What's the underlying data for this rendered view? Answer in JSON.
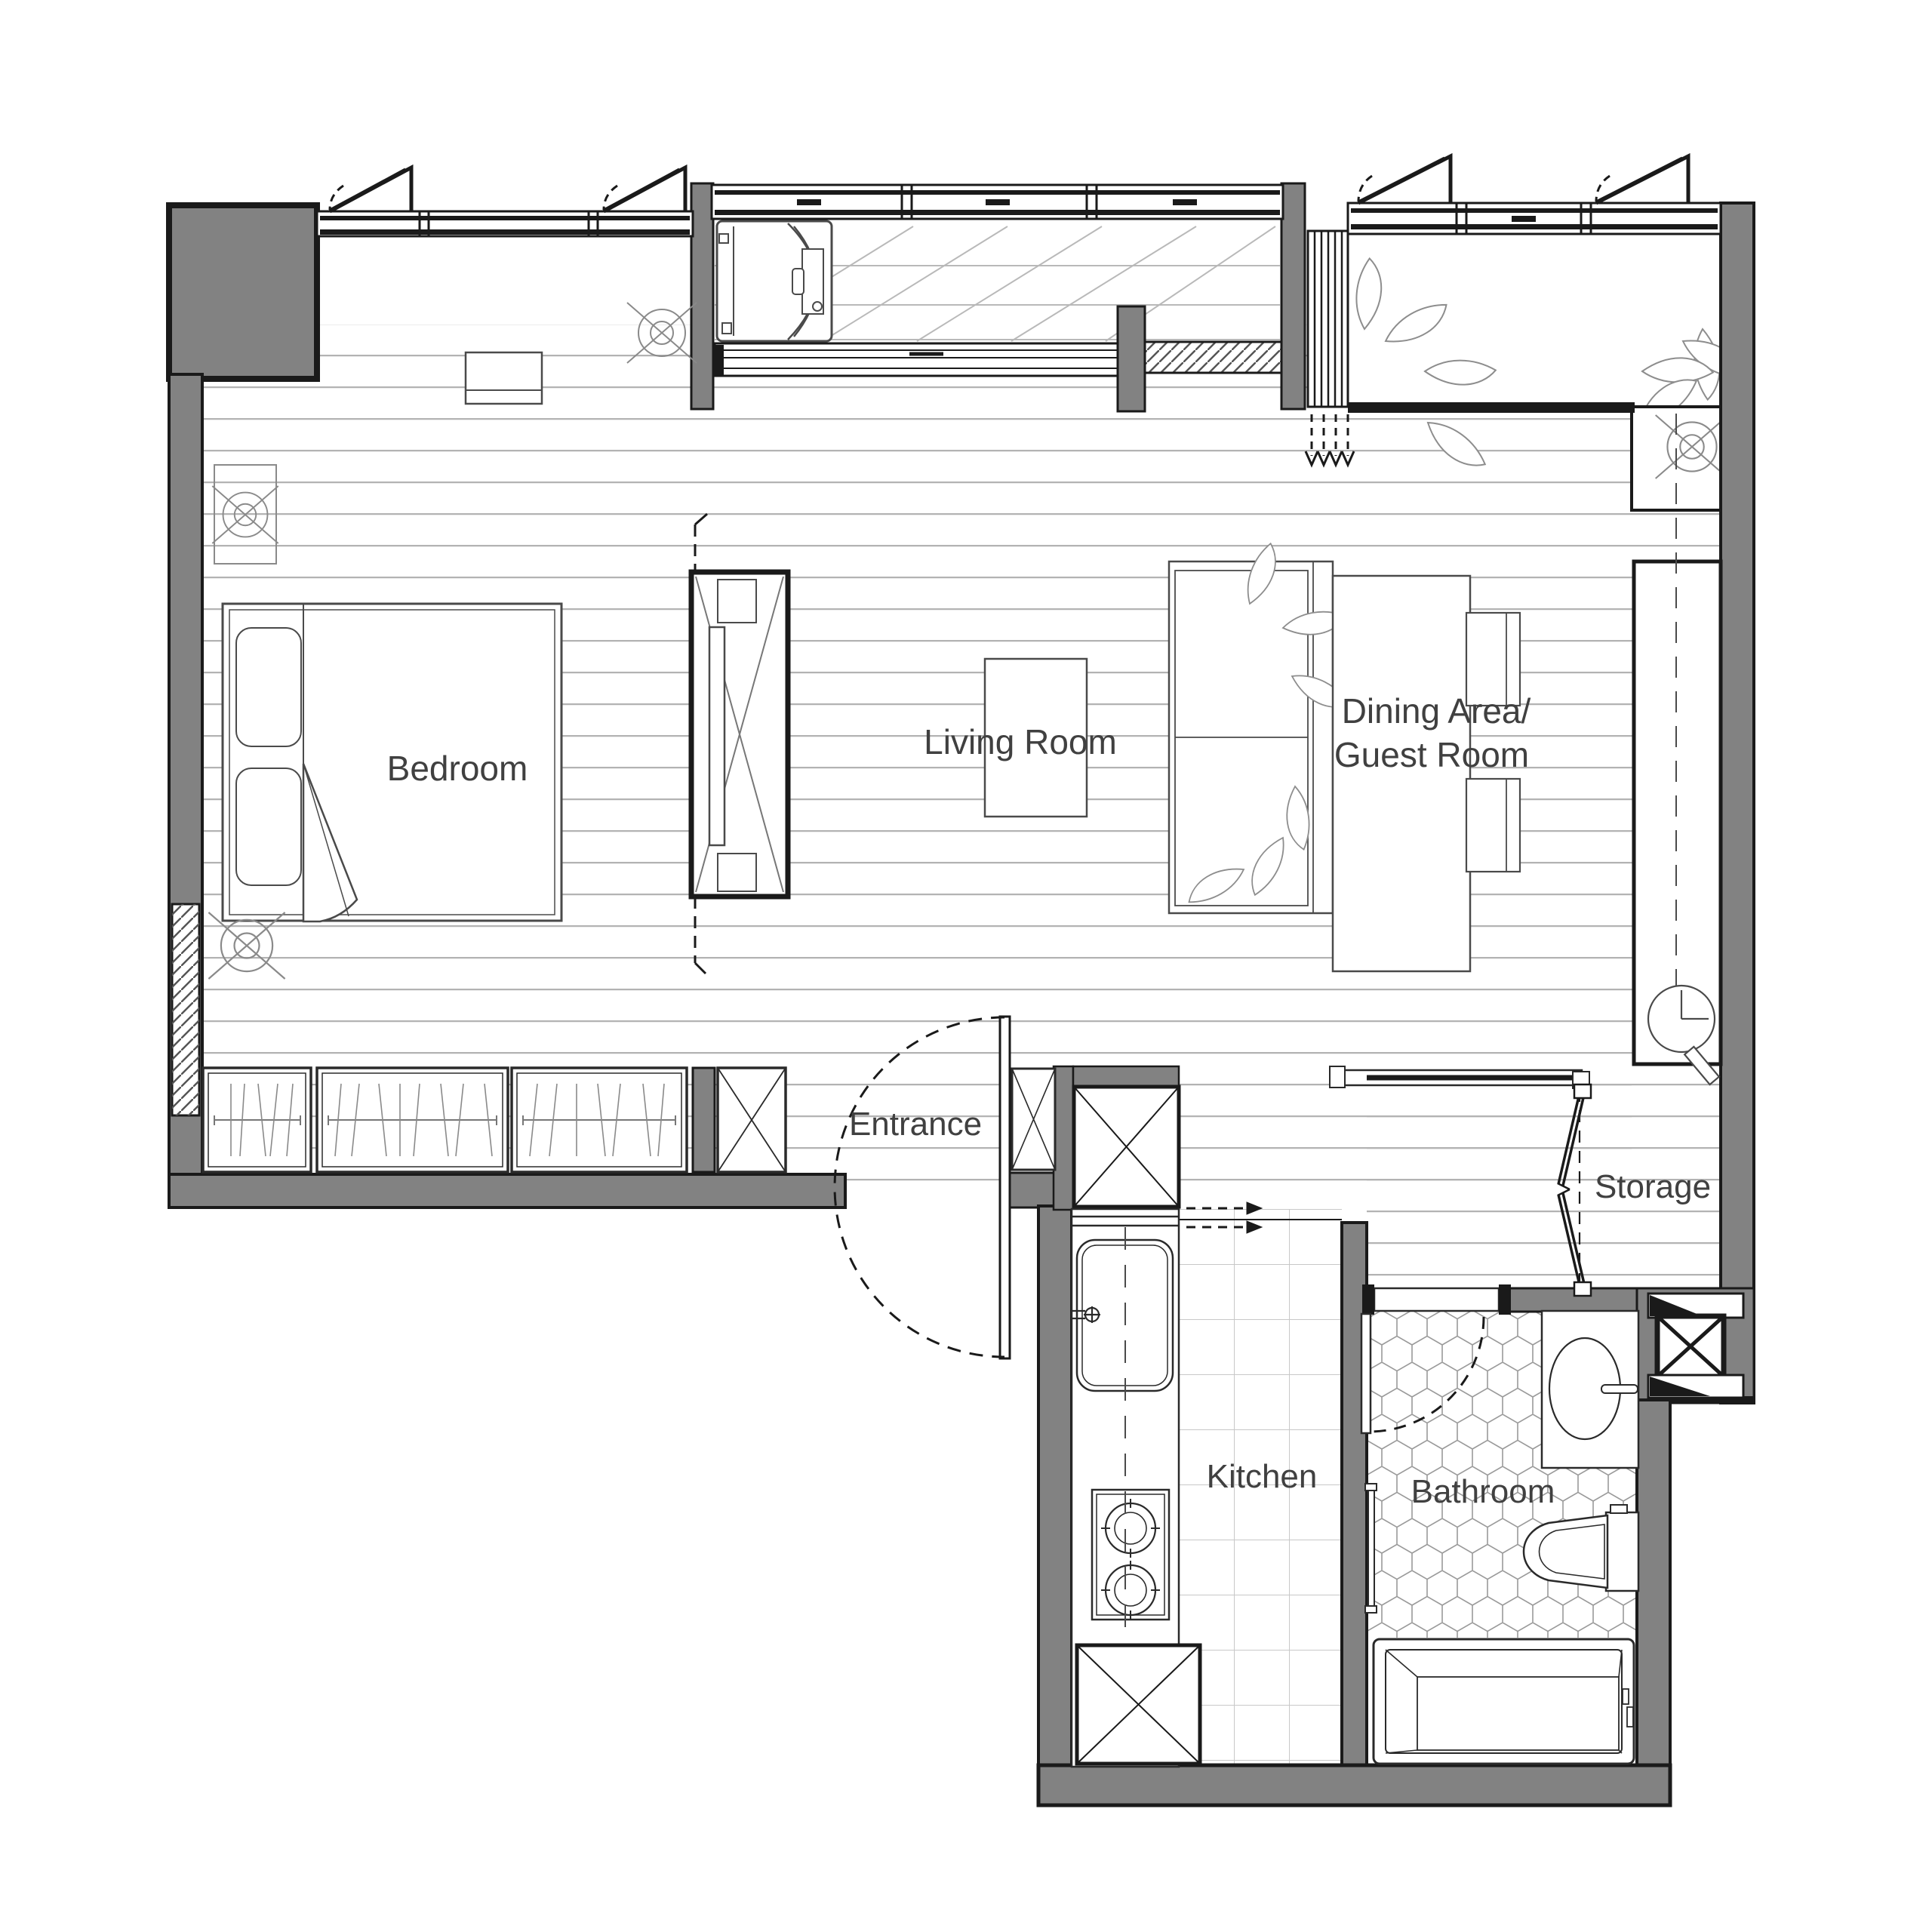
{
  "rooms": {
    "bedroom": {
      "label": "Bedroom"
    },
    "living": {
      "label": "Living Room"
    },
    "dining": {
      "label_line1": "Dining Area/",
      "label_line2": "Guest Room"
    },
    "entrance": {
      "label": "Entrance"
    },
    "kitchen": {
      "label": "Kitchen"
    },
    "bathroom": {
      "label": "Bathroom"
    },
    "storage": {
      "label": "Storage"
    }
  },
  "colors": {
    "wall_gray": "#828282",
    "outline_black": "#1a1a1a",
    "floor_line": "#b3b3b3",
    "tile_line": "#c8c8c8",
    "hex_line": "#9a9a9a",
    "furniture_line": "#4a4a4a",
    "text": "#404040"
  },
  "symbols": {
    "ceiling_light": "circle-with-cross",
    "wall_clock": "clock-face",
    "door_swing": "dashed-arc",
    "drain_direction": "dashed-down-arrows",
    "section_line": "dashed-line-with-tick"
  }
}
